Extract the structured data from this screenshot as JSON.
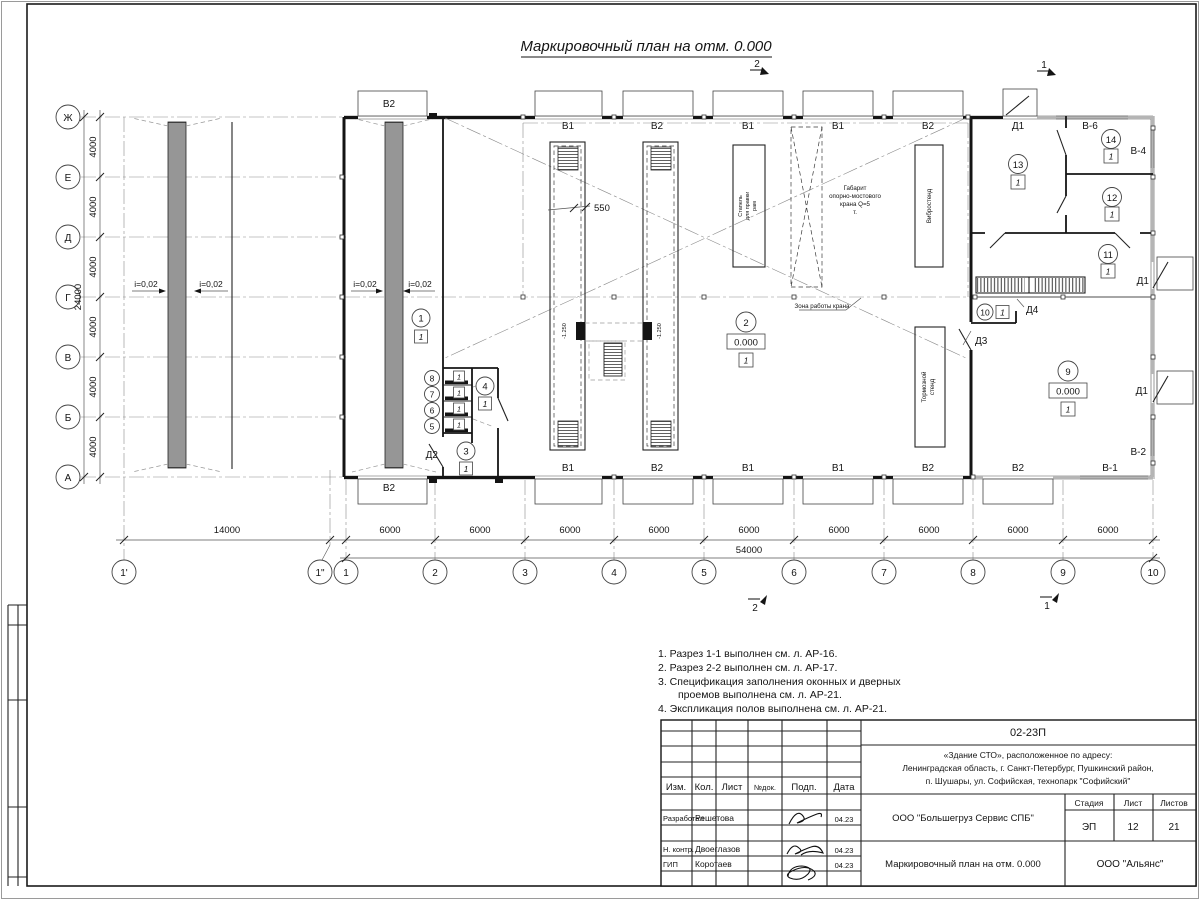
{
  "sheet": {
    "title": "Маркировочный план на отм. 0.000"
  },
  "marks": {
    "one": "1",
    "two": "2"
  },
  "axes": {
    "rows": [
      "Ж",
      "Е",
      "Д",
      "Г",
      "В",
      "Б",
      "А"
    ],
    "cols": [
      "1'",
      "1\"",
      "1",
      "2",
      "3",
      "4",
      "5",
      "6",
      "7",
      "8",
      "9",
      "10"
    ]
  },
  "dims": {
    "bay_v": "4000",
    "total_v": "24000",
    "first_h": "14000",
    "bay_h": "6000",
    "total_h": "54000",
    "trench": "550"
  },
  "plan": {
    "slope": "i=0,02",
    "level_zero": "0.000",
    "trench_level": "-1.250",
    "crane_zone": "Зона работы крана",
    "gabarit": [
      "Габарит",
      "опорно-мостового",
      "крана Q=5",
      "т."
    ],
    "stapel": [
      "Стапель",
      "для правки",
      "рам"
    ],
    "vibro": "Вибростенд",
    "brake": [
      "Тормозной",
      "стенд"
    ],
    "win": {
      "b1": "В1",
      "b2": "В2",
      "v1": "В-1",
      "v2": "В-2",
      "v4": "В-4",
      "v6": "В-6"
    },
    "doors": {
      "d1": "Д1",
      "d2": "Д2",
      "d3": "Д3",
      "d4": "Д4"
    },
    "rooms": [
      "1",
      "2",
      "3",
      "4",
      "5",
      "6",
      "7",
      "8",
      "9",
      "10",
      "11",
      "12",
      "13",
      "14"
    ],
    "expl": "1"
  },
  "notes": [
    "1. Разрез 1-1 выполнен см. л. АР-16.",
    "2. Разрез 2-2 выполнен см. л. АР-17.",
    "3. Спецификация заполнения оконных и дверных",
    "проемов выполнена см. л. АР-21.",
    "4. Экспликация полов выполнена см. л. АР-21."
  ],
  "titleblock": {
    "code": "02-23П",
    "object_lines": [
      "«Здание СТО», расположенное по адресу:",
      "Ленинградская область, г. Санкт-Петербург, Пушкинский район,",
      "п. Шушары, ул. Софийская, технопарк \"Софийский\""
    ],
    "cols": {
      "izm": "Изм.",
      "kol": "Кол.",
      "list": "Лист",
      "ndok": "№док.",
      "podp": "Подп.",
      "data": "Дата"
    },
    "roles": {
      "dev": "Разработал",
      "control": "Н. контр.",
      "gip": "ГИП"
    },
    "names": {
      "dev": "Решетова",
      "control": "Двоеглазов",
      "gip": "Коротаев"
    },
    "date": "04.23",
    "org": "ООО \"Большегруз Сервис СПБ\"",
    "stage_h": {
      "stage": "Стадия",
      "sheet": "Лист",
      "sheets": "Листов"
    },
    "stage_v": {
      "stage": "ЭП",
      "sheet": "12",
      "sheets": "21"
    },
    "drawing": "Маркировочный план на отм. 0.000",
    "company": "ООО \"Альянс\""
  }
}
